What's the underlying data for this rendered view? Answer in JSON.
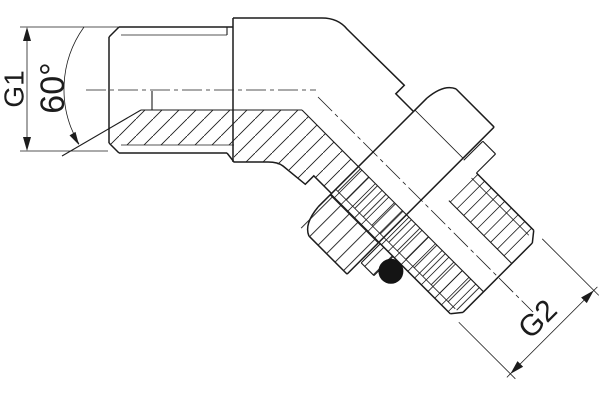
{
  "drawing": {
    "title": "45 degree elbow fitting sectional drawing",
    "view": "half-section technical drawing",
    "labels": {
      "g1": "G1",
      "angle": "60°",
      "g2": "G2"
    }
  },
  "colors": {
    "ink": "#1c1c1c",
    "background": "#ffffff",
    "oring": "#141414"
  }
}
